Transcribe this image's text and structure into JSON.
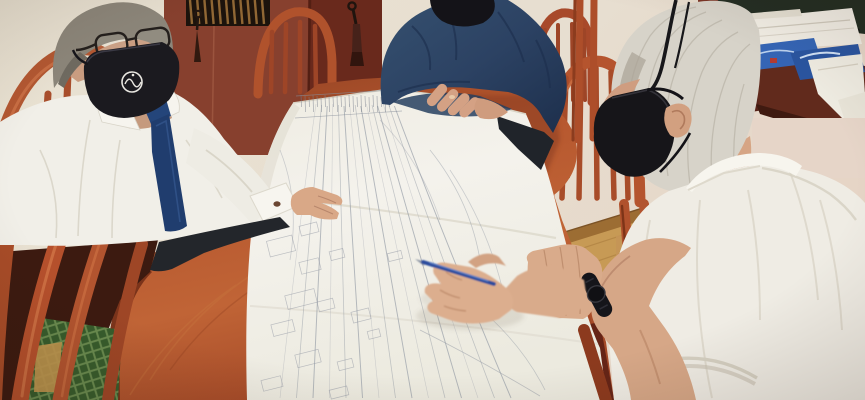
{
  "image": {
    "kind": "photograph",
    "subject": "Three men wearing black face masks review a long technical drawing rolled out across a wooden conference table",
    "setting": "office meeting room",
    "people": [
      "man in white shirt, navy tie, glasses and black face mask with white round emblem, pointing at the drawing",
      "man in dark navy shirt, head cropped by frame, forearms resting on the drawing",
      "gray-haired man in white short-sleeve shirt and black face mask, holding a blue pen, black watch on left wrist"
    ],
    "objects": [
      "long white technical drawing with pencil linework",
      "oval red-brown wooden conference table",
      "spindle-back wooden chairs",
      "dark red cabinet with keys and tassels in the locks",
      "slatted grille above cabinet",
      "desk piled with white papers and blue brochures",
      "green diamond-pattern upholstery and carpet",
      "light wood floor with baseboard",
      "blue ballpoint pen",
      "black wristwatch"
    ]
  },
  "palette": {
    "wall": "#e7e0d0",
    "wall_right": "#e6d5c6",
    "cabinet": "#8a4330",
    "cabinet_dark": "#60261a",
    "grille_dark": "#1c130c",
    "grille_slat": "#a5763c",
    "table": "#b5562e",
    "table_light": "#c4703c",
    "table_dark": "#7e3a20",
    "paper": "#f2efe8",
    "sketch_line": "#8f96a2",
    "chair_wood": "#b2542f",
    "chair_wood_dark": "#8e3d1f",
    "carpet_green": "#426d35",
    "carpet_green_light": "#82a862",
    "navy_shirt": "#2c4263",
    "tie_navy": "#23406e",
    "mask_black": "#1a191e",
    "skin": "#d7a888",
    "hair_gray": "#8e887b",
    "hair_white": "#d7d3c9",
    "floor": "#c79a55",
    "baseboard": "#9c6d33",
    "desk_front": "#612a1c",
    "desk_green_top": "#242e23",
    "brochure_blue": "#2f62b8",
    "brochure_blue_dark": "#2a55a0",
    "pen_blue": "#2b4c9d",
    "trousers": "#23262b"
  }
}
